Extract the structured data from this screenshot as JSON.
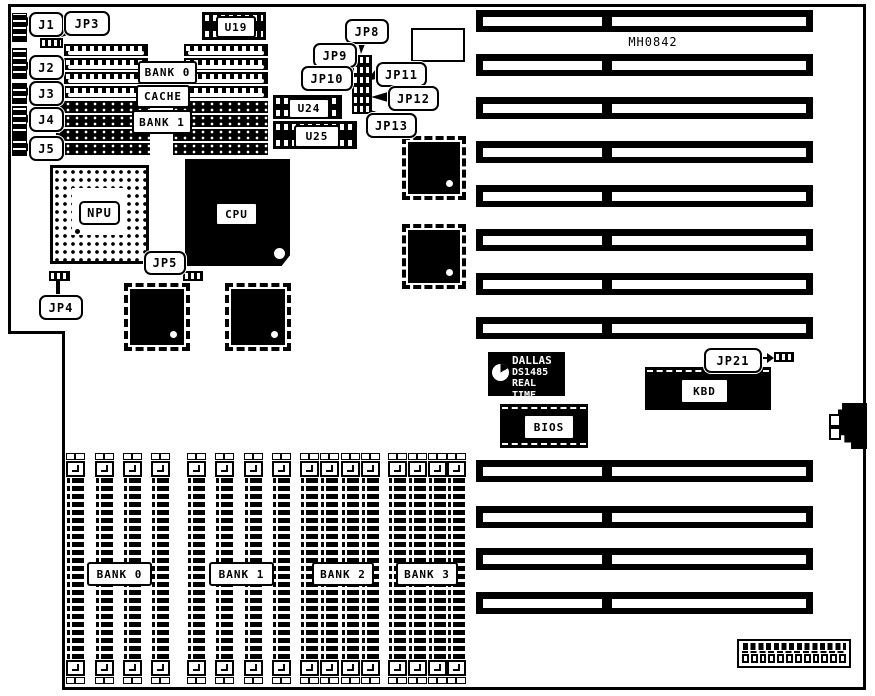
{
  "board": {
    "model_label": "MH0842"
  },
  "edge_connectors": {
    "j1": "J1",
    "j2": "J2",
    "j3": "J3",
    "j4": "J4",
    "j5": "J5"
  },
  "jumpers": {
    "jp3": "JP3",
    "jp4": "JP4",
    "jp5": "JP5",
    "jp8": "JP8",
    "jp9": "JP9",
    "jp10": "JP10",
    "jp11": "JP11",
    "jp12": "JP12",
    "jp13": "JP13",
    "jp21": "JP21"
  },
  "chips": {
    "u19": "U19",
    "u24": "U24",
    "u25": "U25",
    "npu": "NPU",
    "cpu": "CPU",
    "bios": "BIOS",
    "kbd": "KBD",
    "rtc": {
      "line1": "DALLAS",
      "line2": "DS1485",
      "line3": "REAL TIME"
    }
  },
  "memory": {
    "bank0_dip": "BANK 0",
    "cache": "CACHE",
    "bank1_dip": "BANK 1",
    "simm_banks": [
      "BANK 0",
      "BANK 1",
      "BANK 2",
      "BANK 3"
    ]
  },
  "colors": {
    "line": "#000000",
    "background": "#ffffff"
  }
}
